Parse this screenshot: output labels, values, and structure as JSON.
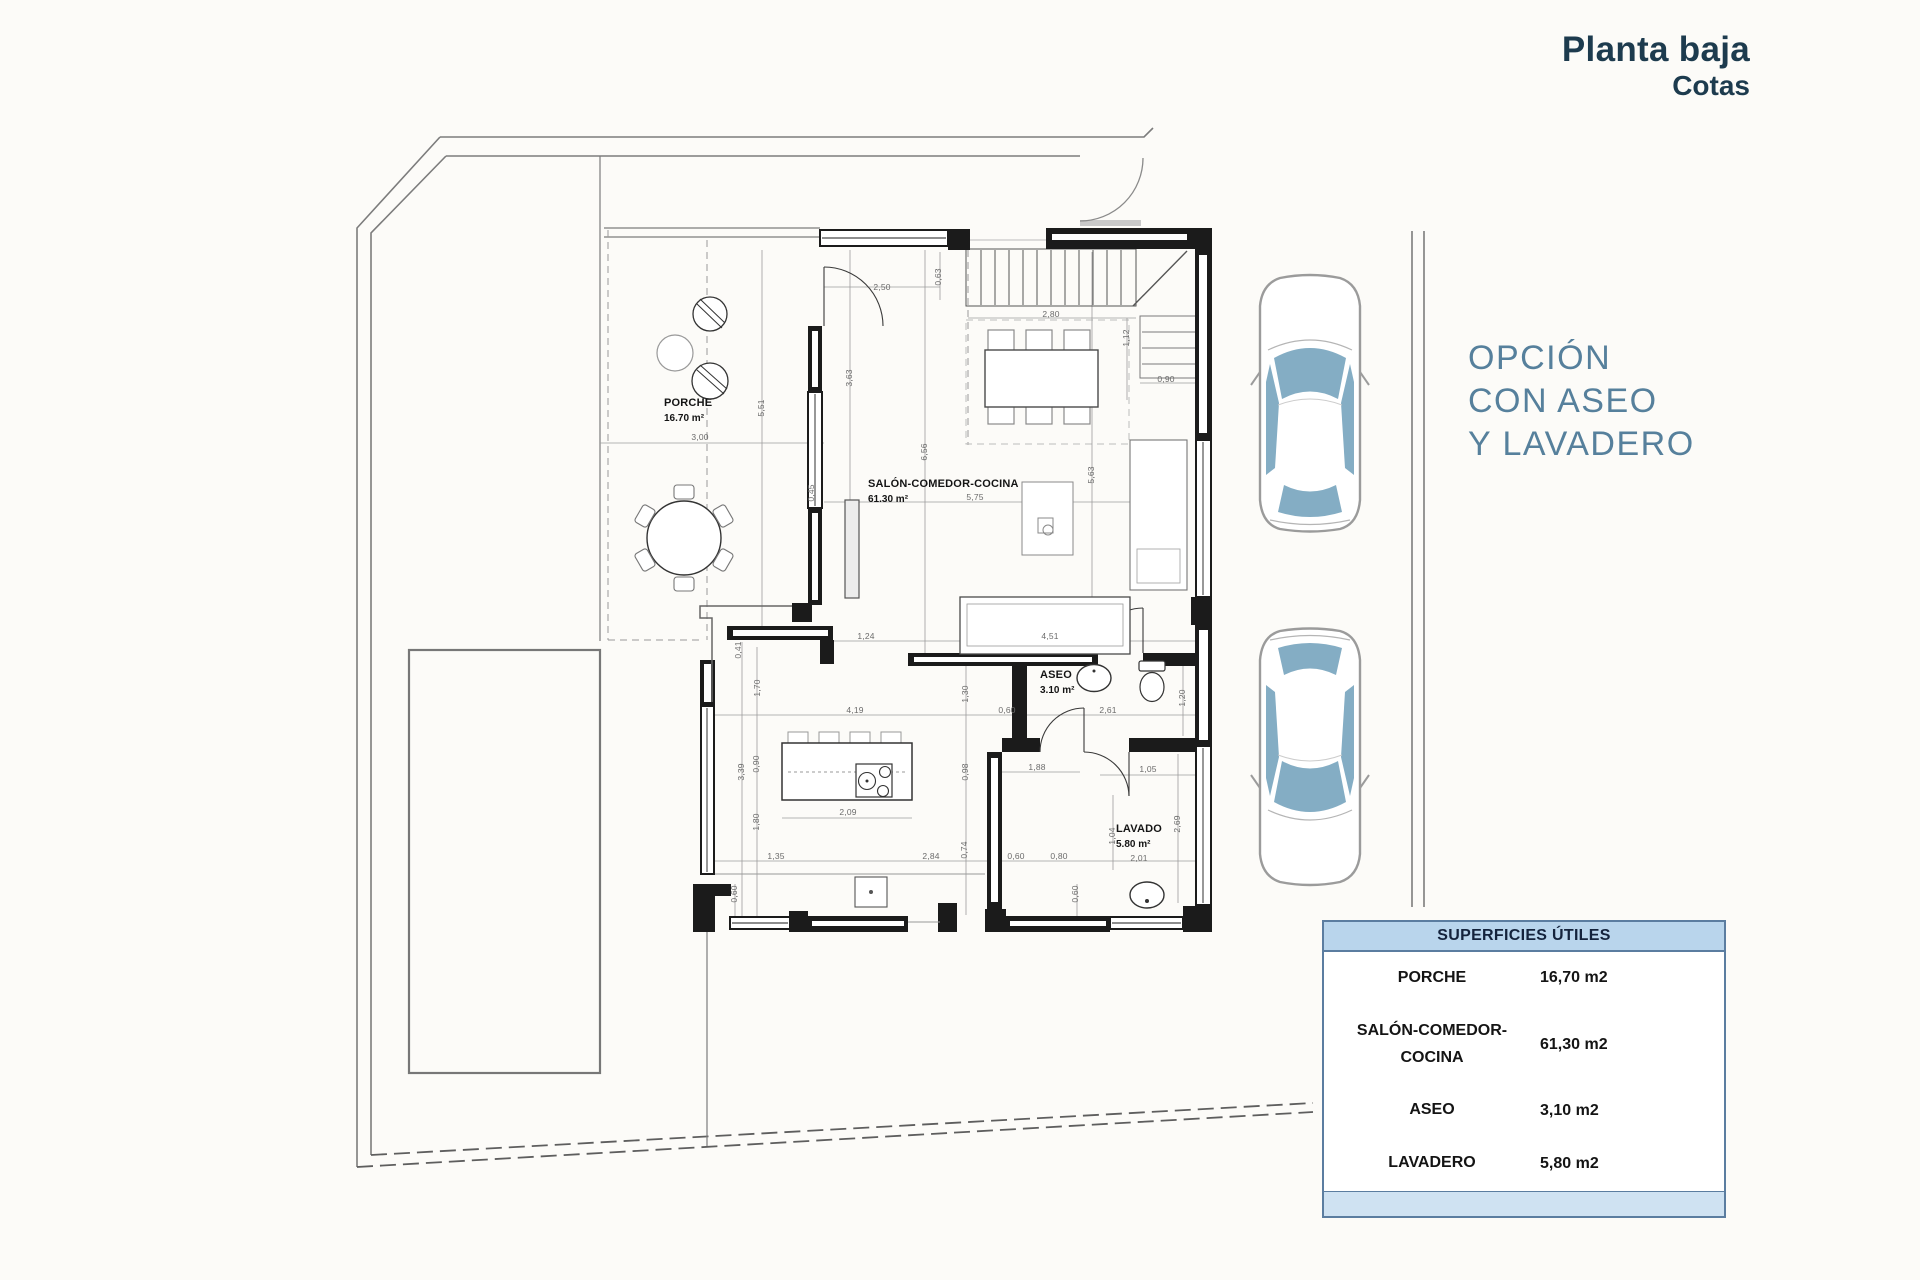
{
  "title": {
    "line1": "Planta baja",
    "line2": "Cotas"
  },
  "option_note": {
    "lines": [
      "OPCIÓN",
      "CON ASEO",
      "Y LAVADERO"
    ]
  },
  "plan": {
    "rooms": [
      {
        "slug": "porche",
        "name": "PORCHE",
        "area": "16.70 m²",
        "x": 664,
        "y": 396
      },
      {
        "slug": "salon",
        "name": "SALÓN-COMEDOR-COCINA",
        "area": "61.30 m²",
        "x": 868,
        "y": 477
      },
      {
        "slug": "aseo",
        "name": "ASEO",
        "area": "3.10 m²",
        "x": 1040,
        "y": 668
      },
      {
        "slug": "lavado",
        "name": "LAVADO",
        "area": "5.80 m²",
        "x": 1116,
        "y": 822
      }
    ],
    "dims": [
      {
        "t": "2,50",
        "x": 882,
        "y": 287
      },
      {
        "t": "0,63",
        "x": 938,
        "y": 277,
        "r": 1
      },
      {
        "t": "2,80",
        "x": 1051,
        "y": 314
      },
      {
        "t": "1,12",
        "x": 1126,
        "y": 338,
        "r": 1
      },
      {
        "t": "0,90",
        "x": 1166,
        "y": 379
      },
      {
        "t": "3,63",
        "x": 849,
        "y": 378,
        "r": 1
      },
      {
        "t": "5,51",
        "x": 761,
        "y": 408,
        "r": 1
      },
      {
        "t": "3,00",
        "x": 700,
        "y": 437
      },
      {
        "t": "6,56",
        "x": 924,
        "y": 452,
        "r": 1
      },
      {
        "t": "5,63",
        "x": 1091,
        "y": 475,
        "r": 1
      },
      {
        "t": "5,75",
        "x": 975,
        "y": 497
      },
      {
        "t": "0,45",
        "x": 811,
        "y": 493,
        "r": 1
      },
      {
        "t": "1,24",
        "x": 866,
        "y": 636
      },
      {
        "t": "4,51",
        "x": 1050,
        "y": 636
      },
      {
        "t": "0,41",
        "x": 738,
        "y": 650,
        "r": 1
      },
      {
        "t": "1,70",
        "x": 757,
        "y": 688,
        "r": 1
      },
      {
        "t": "1,30",
        "x": 965,
        "y": 694,
        "r": 1
      },
      {
        "t": "0,60",
        "x": 1007,
        "y": 710
      },
      {
        "t": "2,61",
        "x": 1108,
        "y": 710
      },
      {
        "t": "1,20",
        "x": 1182,
        "y": 698,
        "r": 1
      },
      {
        "t": "4,19",
        "x": 855,
        "y": 710
      },
      {
        "t": "0,90",
        "x": 756,
        "y": 764,
        "r": 1
      },
      {
        "t": "0,98",
        "x": 965,
        "y": 772,
        "r": 1
      },
      {
        "t": "1,88",
        "x": 1037,
        "y": 767
      },
      {
        "t": "1,05",
        "x": 1148,
        "y": 769
      },
      {
        "t": "3,39",
        "x": 741,
        "y": 772,
        "r": 1
      },
      {
        "t": "2,09",
        "x": 848,
        "y": 812
      },
      {
        "t": "1,80",
        "x": 756,
        "y": 822,
        "r": 1
      },
      {
        "t": "1,04",
        "x": 1112,
        "y": 836,
        "r": 1
      },
      {
        "t": "2,69",
        "x": 1177,
        "y": 824,
        "r": 1
      },
      {
        "t": "1,35",
        "x": 776,
        "y": 856
      },
      {
        "t": "2,84",
        "x": 931,
        "y": 856
      },
      {
        "t": "0,74",
        "x": 964,
        "y": 850,
        "r": 1
      },
      {
        "t": "0,60",
        "x": 1016,
        "y": 856
      },
      {
        "t": "0,80",
        "x": 1059,
        "y": 856
      },
      {
        "t": "2,01",
        "x": 1139,
        "y": 858
      },
      {
        "t": "0,60",
        "x": 734,
        "y": 894,
        "r": 1
      },
      {
        "t": "0,60",
        "x": 1075,
        "y": 894,
        "r": 1
      }
    ]
  },
  "areas_table": {
    "header": "SUPERFICIES ÚTILES",
    "rows": [
      {
        "lines": [
          "PORCHE"
        ],
        "value": "16,70 m2"
      },
      {
        "lines": [
          "SALÓN-COMEDOR-",
          "COCINA"
        ],
        "value": "61,30 m2"
      },
      {
        "lines": [
          "ASEO"
        ],
        "value": "3,10 m2"
      },
      {
        "lines": [
          "LAVADERO"
        ],
        "value": "5,80 m2"
      }
    ]
  },
  "colors": {
    "title_navy": "#1d3b4e",
    "option_blue": "#56809c",
    "table_header_blue": "#b9d5ec",
    "table_footer_blue": "#cfe2f2",
    "car_window_blue": "#84adc4"
  }
}
